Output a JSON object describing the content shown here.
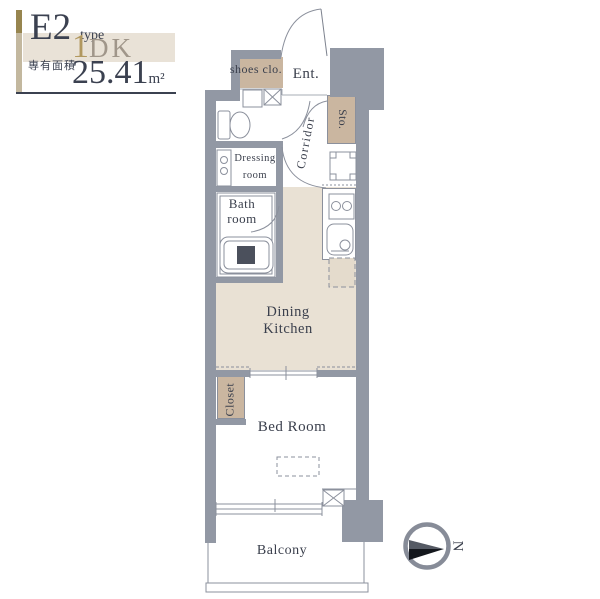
{
  "header": {
    "plan_code": "E2",
    "plan_type_suffix": "type",
    "layout_number": "1",
    "layout_letters": "DK",
    "area_label": "専有面積",
    "area_value": "25.41",
    "area_unit": "m²"
  },
  "plan": {
    "labels": {
      "shoes_closet": "shoes clo.",
      "entrance": "Ent.",
      "corridor": "Corridor",
      "storage": "Sto.",
      "washer": "W",
      "dressing_line1": "Dressing",
      "dressing_line2": "room",
      "bath_line1": "Bath",
      "bath_line2": "room",
      "fridge": "R",
      "dining_kitchen_line1": "Dining",
      "dining_kitchen_line2": "Kitchen",
      "closet": "Closet",
      "bedroom": "Bed Room",
      "ac_unit": "AC",
      "balcony": "Balcony"
    }
  },
  "compass": {
    "north": "N"
  },
  "colors": {
    "wall": "#9298a4",
    "line": "#8b909c",
    "room_beige": "#e9e1d4",
    "accent_tan": "#cab6a0",
    "text": "#3a3f4c",
    "gold": "#b1985f"
  }
}
